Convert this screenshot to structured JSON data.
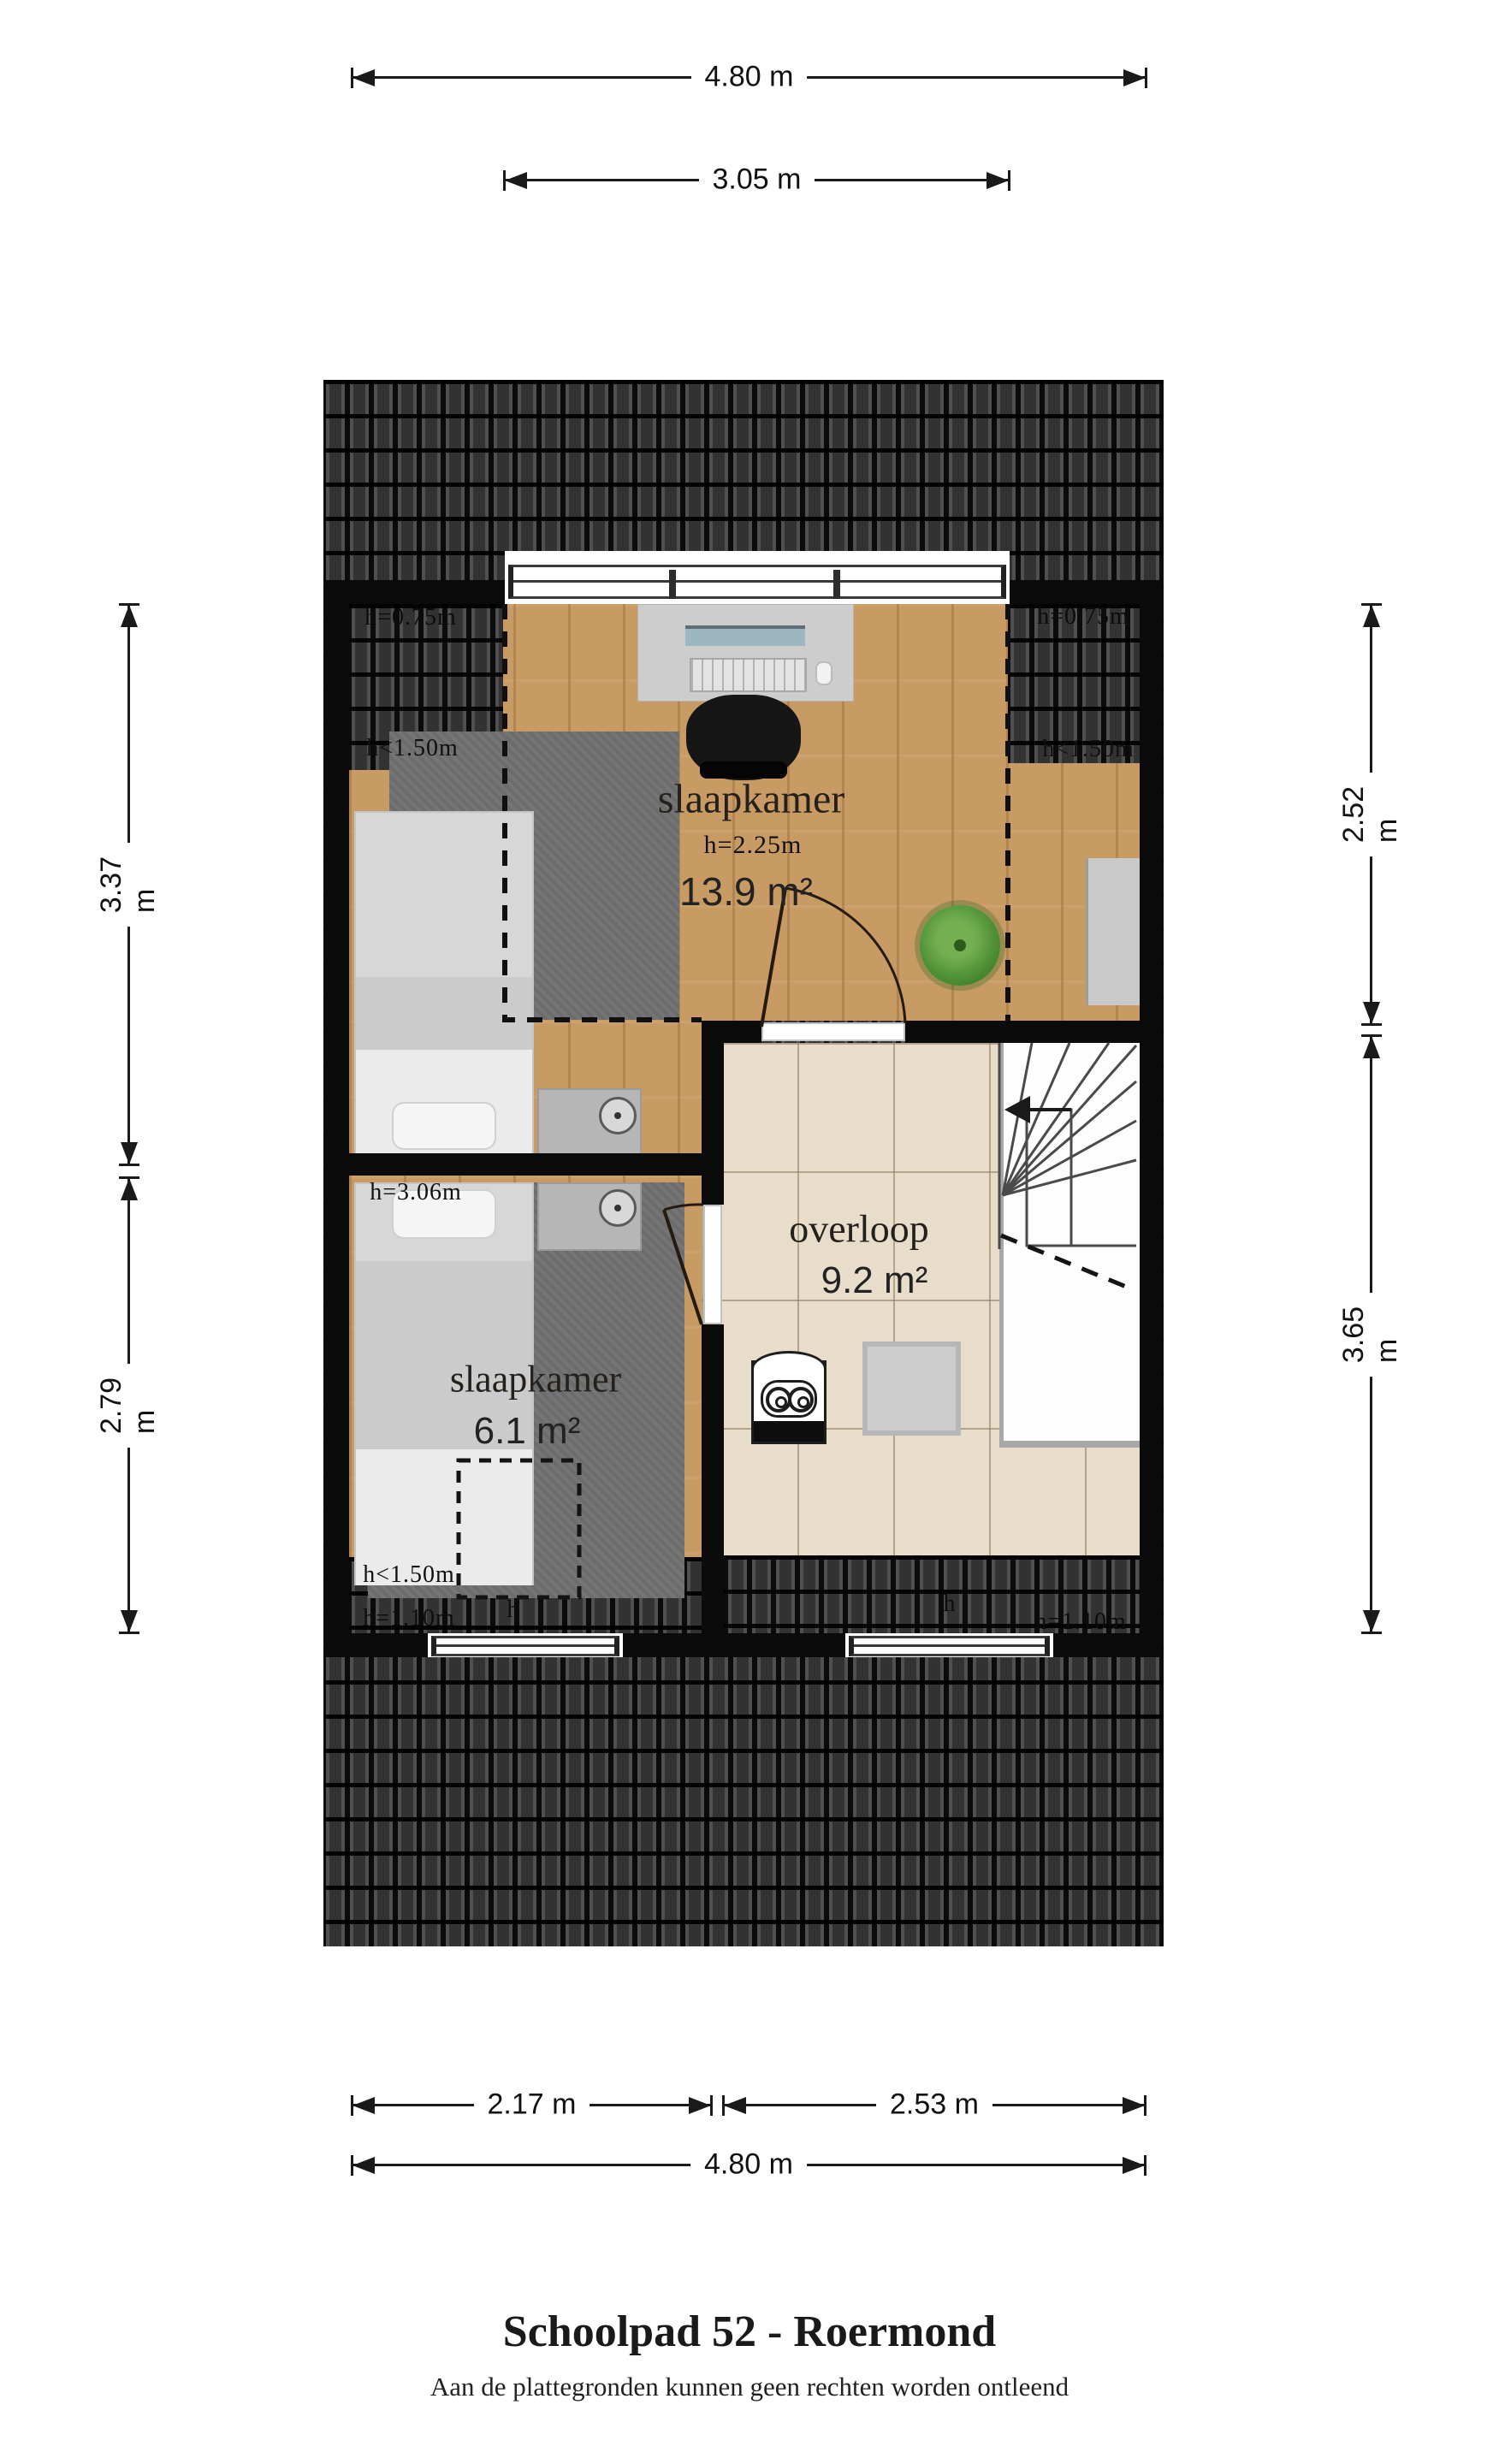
{
  "page": {
    "title": "Schoolpad 52 - Roermond",
    "disclaimer": "Aan de plattegronden kunnen geen rechten worden ontleend"
  },
  "dimensions": {
    "top_total": "4.80 m",
    "top_dormer": "3.05 m",
    "left_upper": "3.37 m",
    "left_lower": "2.79 m",
    "right_upper": "2.52 m",
    "right_lower": "3.65 m",
    "bottom_left": "2.17 m",
    "bottom_right": "2.53 m",
    "bottom_total": "4.80 m"
  },
  "rooms": {
    "bedroom_large": {
      "name": "slaapkamer",
      "ceiling": "h=2.25m",
      "area": "13.9 m²"
    },
    "landing": {
      "name": "overloop",
      "area": "9.2 m²"
    },
    "bedroom_small": {
      "name": "slaapkamer",
      "ceiling": "h=3.06m",
      "area": "6.1 m²"
    }
  },
  "height_labels": {
    "top_left": "h=0.75m",
    "top_right": "h=0.75m",
    "mid_left": "h<1.50m",
    "mid_right": "h<1.50m",
    "low_left": "h<1.50m",
    "bottom_left": "h=1.10m",
    "bottom_right": "h=1.10m",
    "window_left": "h",
    "window_right": "h"
  },
  "colors": {
    "roof_tiles": "#2c2c2c",
    "wall": "#0b0b0b",
    "wood_floor": "#c89b64",
    "rug": "#757575",
    "tile_floor": "#e8ddca",
    "plant": "#4d8f35",
    "text": "#181512"
  }
}
